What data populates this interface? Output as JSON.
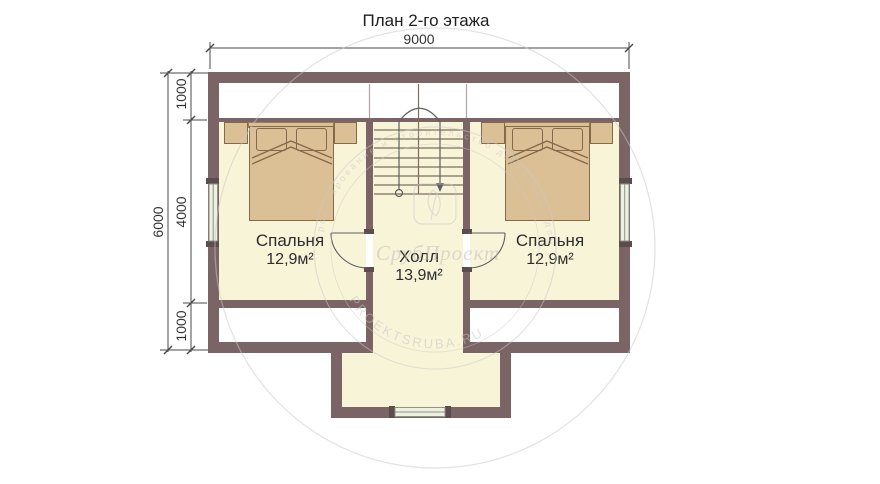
{
  "title": "План 2-го этажа",
  "dimensions": {
    "width_top": "9000",
    "height_total": "6000",
    "segments_left": [
      "1000",
      "4000",
      "1000"
    ]
  },
  "rooms": {
    "bedroom_left": {
      "name": "Спальня",
      "area": "12,9м²"
    },
    "hall": {
      "name": "Холл",
      "area": "13,9м²"
    },
    "bedroom_right": {
      "name": "Спальня",
      "area": "12,9м²"
    }
  },
  "watermark": {
    "brand": "СрубПроект",
    "site": "PROEKTSRUBA.RU",
    "ring_text": "проектирование и строительство деревянных домов"
  },
  "colors": {
    "wall": "#7b6465",
    "floor": "#f8f4d8",
    "furniture": "#dcc095",
    "window": "#eef1e2",
    "watermark": "#c6c6c6",
    "text": "#2d2d2d"
  }
}
